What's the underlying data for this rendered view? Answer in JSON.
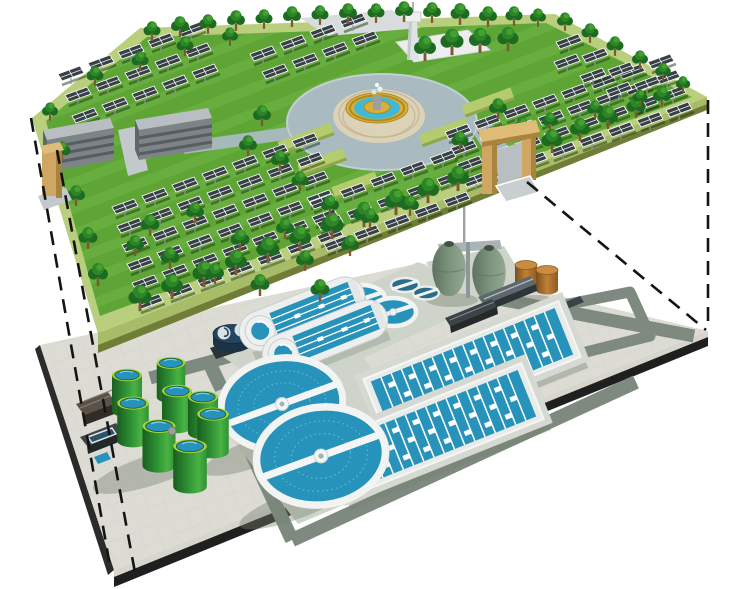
{
  "meta": {
    "subject": "Cutaway 3D illustration of an underground wastewater treatment plant located beneath a ground-level solar panel park",
    "style": "isometric architectural rendering, no visible text"
  },
  "layers": {
    "upper": {
      "name": "ground-level solar park",
      "components": [
        {
          "label": "solar panel arrays",
          "count": 120
        },
        {
          "label": "trees",
          "count": 75
        },
        {
          "label": "central fountain plaza",
          "count": 1
        },
        {
          "label": "office buildings",
          "count": 2
        },
        {
          "label": "observation tower",
          "count": 1
        },
        {
          "label": "entrance gates",
          "count": 2
        }
      ]
    },
    "lower": {
      "name": "underground wastewater treatment plant",
      "components": [
        {
          "label": "circular clarifiers",
          "count": 2
        },
        {
          "label": "oxidation ditches",
          "count": 2
        },
        {
          "label": "aeration basins",
          "count": 2
        },
        {
          "label": "green sludge storage tanks",
          "count": 8
        },
        {
          "label": "egg-shaped digesters",
          "count": 2
        },
        {
          "label": "brown storage tanks",
          "count": 2
        },
        {
          "label": "gravity thickeners",
          "count": 2
        },
        {
          "label": "small process tanks",
          "count": 2
        },
        {
          "label": "red pump station",
          "count": 1
        },
        {
          "label": "service buildings",
          "count": 6
        }
      ]
    },
    "projection_lines": {
      "label": "dashed cutaway projection lines",
      "count": 4
    }
  },
  "colors": {
    "bg": "#ffffff",
    "grass": "#5ea536",
    "berm": "#b9cf7e",
    "berm_side": "#a8bc67",
    "side": "#6f7d36",
    "side_dark": "#545f28",
    "tree_dark": "#1d6b21",
    "tree_mid": "#2c8527",
    "tree_light": "#44a12f",
    "trunk": "#7a5a2e",
    "panel": "#394045",
    "panel_grid": "#e8eef0",
    "pole": "#8e9699",
    "panel_shadow": "#1c3a14",
    "plaza_road": "#a9bac0",
    "pavers": "#dbd2b8",
    "paver_line": "#c5b897",
    "gold": "#d9ae3c",
    "gold_dark": "#b08a20",
    "water": "#3fb9d4",
    "roof": "#b9bec2",
    "bface": "#7d8387",
    "bstripe": "#565e62",
    "gate": "#cfa763",
    "gate_side": "#a8843f",
    "gate_top": "#e0bc79",
    "pave": "#dcdcd4",
    "pave_grid": "#c6c6bd",
    "road": "#7e8a7f",
    "apron": "#cfd4cb",
    "shadow": "#75806f",
    "edge_light": "#d6d6cd",
    "edge_dark": "#1f1f1f",
    "white_tank": "#f0f2f1",
    "tank_shade": "#c2c8ca",
    "basin": "#2793bb",
    "basin_light": "#56b8d8",
    "gtank": "#2e9235",
    "gtank_dark": "#1a5e1f",
    "gtank_rim": "#a9d23c",
    "egg": "#7e957e",
    "egg_dark": "#5d735f",
    "brown": "#c08136",
    "brown_dark": "#8f5a22",
    "red": "#c5472a",
    "red_dark": "#8e2f1b",
    "dark_b": "#3c4347",
    "dark_b_face": "#24292c",
    "steel": "#aab3b5",
    "swirl": "#2a4f6e",
    "dash": "#141414"
  }
}
